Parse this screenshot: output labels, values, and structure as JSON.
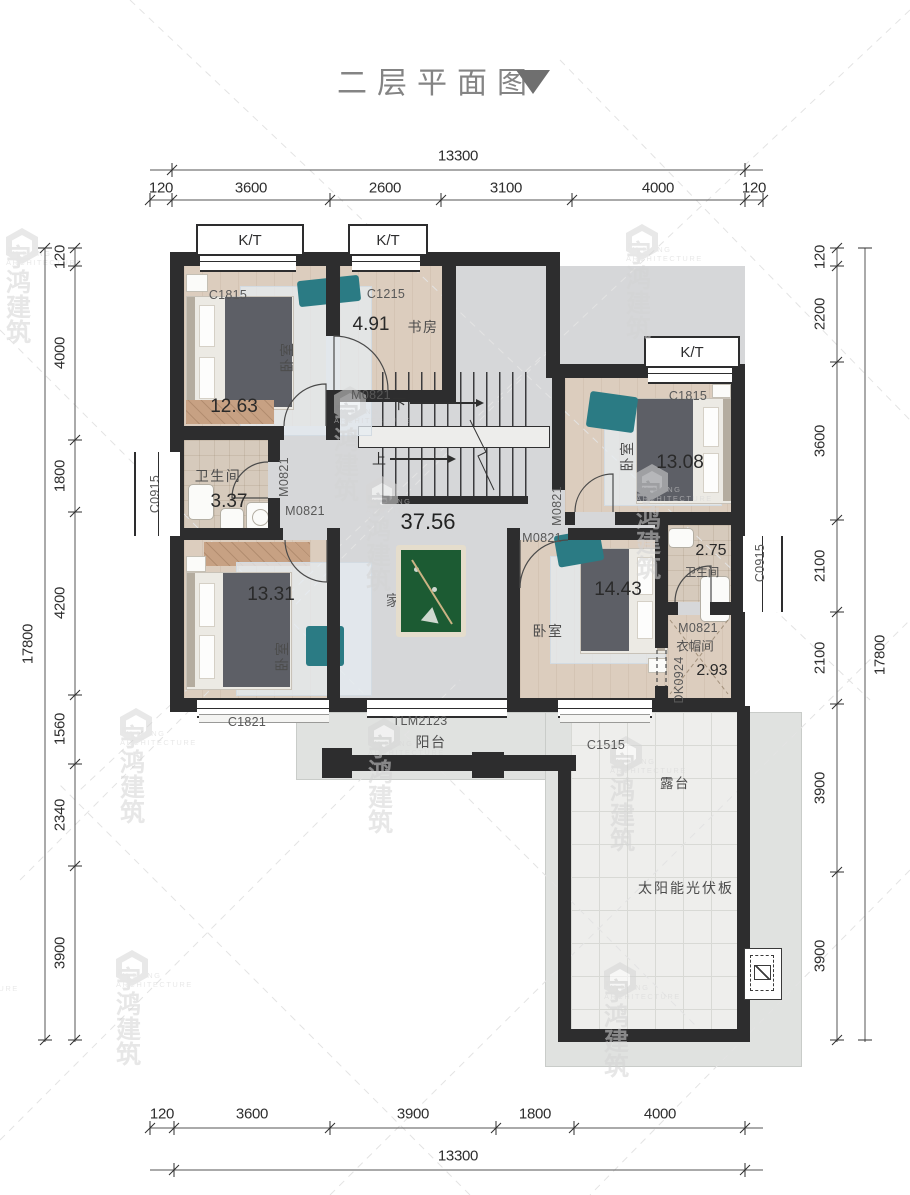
{
  "title": {
    "text": "二层平面图"
  },
  "watermark": {
    "cn": "宇鸿建筑",
    "en": "YU HONG ARCHITECTURE"
  },
  "dims": {
    "top_total": "13300",
    "top": [
      "120",
      "3600",
      "2600",
      "3100",
      "4000",
      "120"
    ],
    "bottom_total": "13300",
    "bottom": [
      "120",
      "3600",
      "3900",
      "1800",
      "4000"
    ],
    "left_total": "17800",
    "left": [
      "120",
      "4000",
      "1800",
      "4200",
      "1560",
      "2340",
      "3900"
    ],
    "right_total": "17800",
    "right": [
      "120",
      "2200",
      "3600",
      "2100",
      "2100",
      "3900",
      "3900"
    ]
  },
  "openings": {
    "kt": "K/T",
    "c1815": "C1815",
    "c1215": "C1215",
    "c0915": "C0915",
    "c1821": "C1821",
    "c1515": "C1515",
    "tlm2123": "TLM2123",
    "dk0924": "DK0924",
    "m0821": "M0821"
  },
  "rooms": {
    "bedroom_tl": {
      "name": "卧室",
      "area": "12.63"
    },
    "study": {
      "name": "书房",
      "area": "4.91"
    },
    "bath_left": {
      "name": "卫生间",
      "area": "3.37"
    },
    "bedroom_bl": {
      "name": "卧室",
      "area": "13.31"
    },
    "activity": {
      "name": "家庭活动室",
      "area": "37.56"
    },
    "bedroom_tr": {
      "name": "卧室",
      "area": "13.08"
    },
    "bedroom_br": {
      "name": "卧室",
      "area": "14.43"
    },
    "bath_right": {
      "name": "卫生间",
      "area": "2.75"
    },
    "cloakroom": {
      "name": "衣帽间",
      "area": "2.93"
    },
    "balcony": {
      "name": "阳台"
    },
    "terrace": {
      "name": "露台"
    },
    "solar": {
      "name": "太阳能光伏板"
    }
  },
  "stairs": {
    "down": "下",
    "up": "上"
  }
}
